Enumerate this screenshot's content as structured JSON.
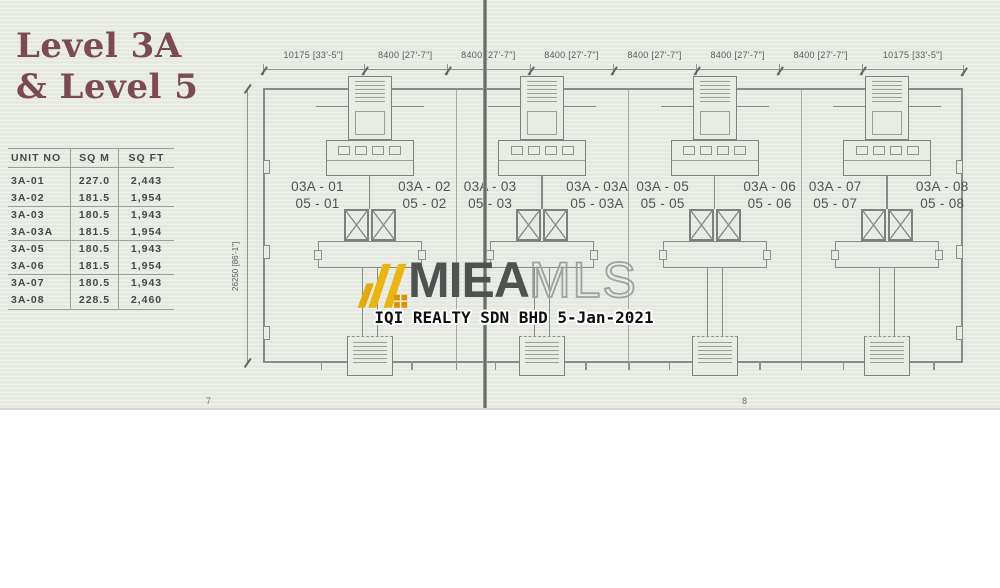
{
  "page": {
    "title_line1": "Level 3A",
    "title_line2": "& Level 5",
    "page_number_left": "7",
    "page_number_right": "8",
    "paper_color": "#E9ECE5",
    "title_color": "#7B4A54",
    "plan_line_color": "#848D87"
  },
  "table": {
    "headers": [
      "UNIT NO",
      "SQ M",
      "SQ FT"
    ],
    "rows": [
      [
        "3A-01",
        "227.0",
        "2,443"
      ],
      [
        "3A-02",
        "181.5",
        "1,954"
      ],
      [
        "3A-03",
        "180.5",
        "1,943"
      ],
      [
        "3A-03A",
        "181.5",
        "1,954"
      ],
      [
        "3A-05",
        "180.5",
        "1,943"
      ],
      [
        "3A-06",
        "181.5",
        "1,954"
      ],
      [
        "3A-07",
        "180.5",
        "1,943"
      ],
      [
        "3A-08",
        "228.5",
        "2,460"
      ]
    ]
  },
  "plan": {
    "dimensions_top": [
      "10175 [33'-5\"]",
      "8400 [27'-7\"]",
      "8400 [27'-7\"]",
      "8400 [27'-7\"]",
      "8400 [27'-7\"]",
      "8400 [27'-7\"]",
      "8400 [27'-7\"]",
      "10175 [33'-5\"]"
    ],
    "dimension_left": "26250 [86'-1\"]",
    "units": [
      {
        "left_top": "03A - 01",
        "left_bottom": "05 - 01",
        "right_top": "03A - 02",
        "right_bottom": "05 - 02"
      },
      {
        "left_top": "03A - 03",
        "left_bottom": "05 - 03",
        "right_top": "03A - 03A",
        "right_bottom": "05 - 03A"
      },
      {
        "left_top": "03A - 05",
        "left_bottom": "05 - 05",
        "right_top": "03A - 06",
        "right_bottom": "05 - 06"
      },
      {
        "left_top": "03A - 07",
        "left_bottom": "05 - 07",
        "right_top": "03A - 08",
        "right_bottom": "05 - 08"
      }
    ]
  },
  "watermark": {
    "brand_bold": "MIEA",
    "brand_light": "MLS",
    "caption": "IQI REALTY SDN BHD 5-Jan-2021",
    "logo_color": "#E8B30D",
    "logo_accent_color": "#E09000"
  }
}
